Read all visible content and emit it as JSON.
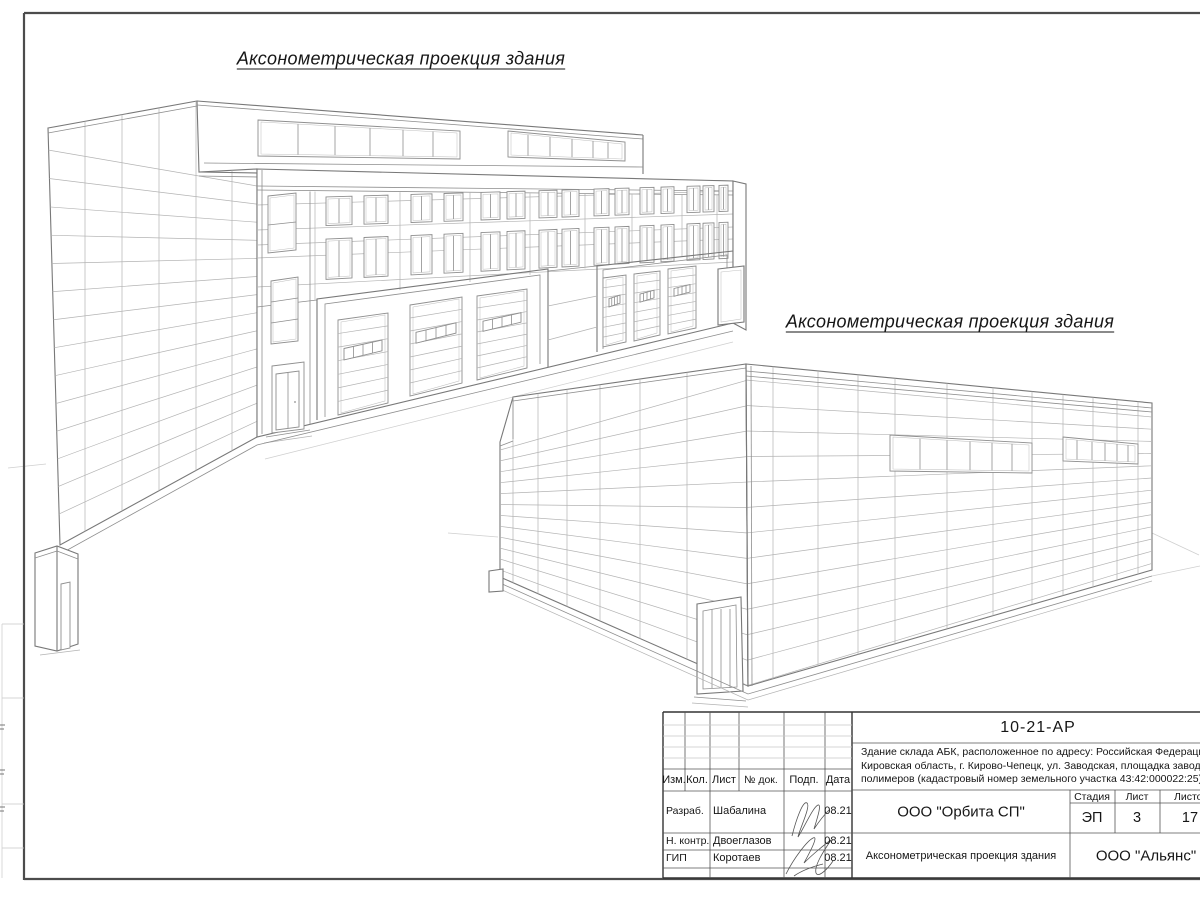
{
  "sheet": {
    "caption_top": "Аксонометрическая проекция здания",
    "caption_bottom": "Аксонометрическая проекция здания"
  },
  "title_block": {
    "doc_number": "10-21-АР",
    "address_line1": "Здание склада АБК, расположенное по адресу: Российская Федерация,",
    "address_line2": "Кировская область, г. Кирово-Чепецк, ул. Заводская, площадка завода",
    "address_line3": "полимеров (кадастровый номер земельного участка 43:42:000022:25)",
    "org": "ООО \"Орбита СП\"",
    "org2": "ООО \"Альянс\"",
    "sheet_title": "Аксонометрическая проекция здания",
    "col_izm": "Изм.",
    "col_kol": "Кол.",
    "col_list": "Лист",
    "col_doc": "№ док.",
    "col_sign": "Подп.",
    "col_date": "Дата",
    "stage_label": "Стадия",
    "sheet_label": "Лист",
    "sheets_label": "Листов",
    "stage_value": "ЭП",
    "sheet_value": "3",
    "sheets_value": "17",
    "rows": [
      {
        "role": "Разраб.",
        "name": "Шабалина",
        "date": "08.21"
      },
      {
        "role": "Н. контр.",
        "name": "Двоеглазов",
        "date": "08.21"
      },
      {
        "role": "ГИП",
        "name": "Коротаев",
        "date": "08.21"
      }
    ]
  },
  "colors": {
    "line": "#8e8e8e",
    "frame": "#4c4c4c",
    "text": "#161616"
  }
}
